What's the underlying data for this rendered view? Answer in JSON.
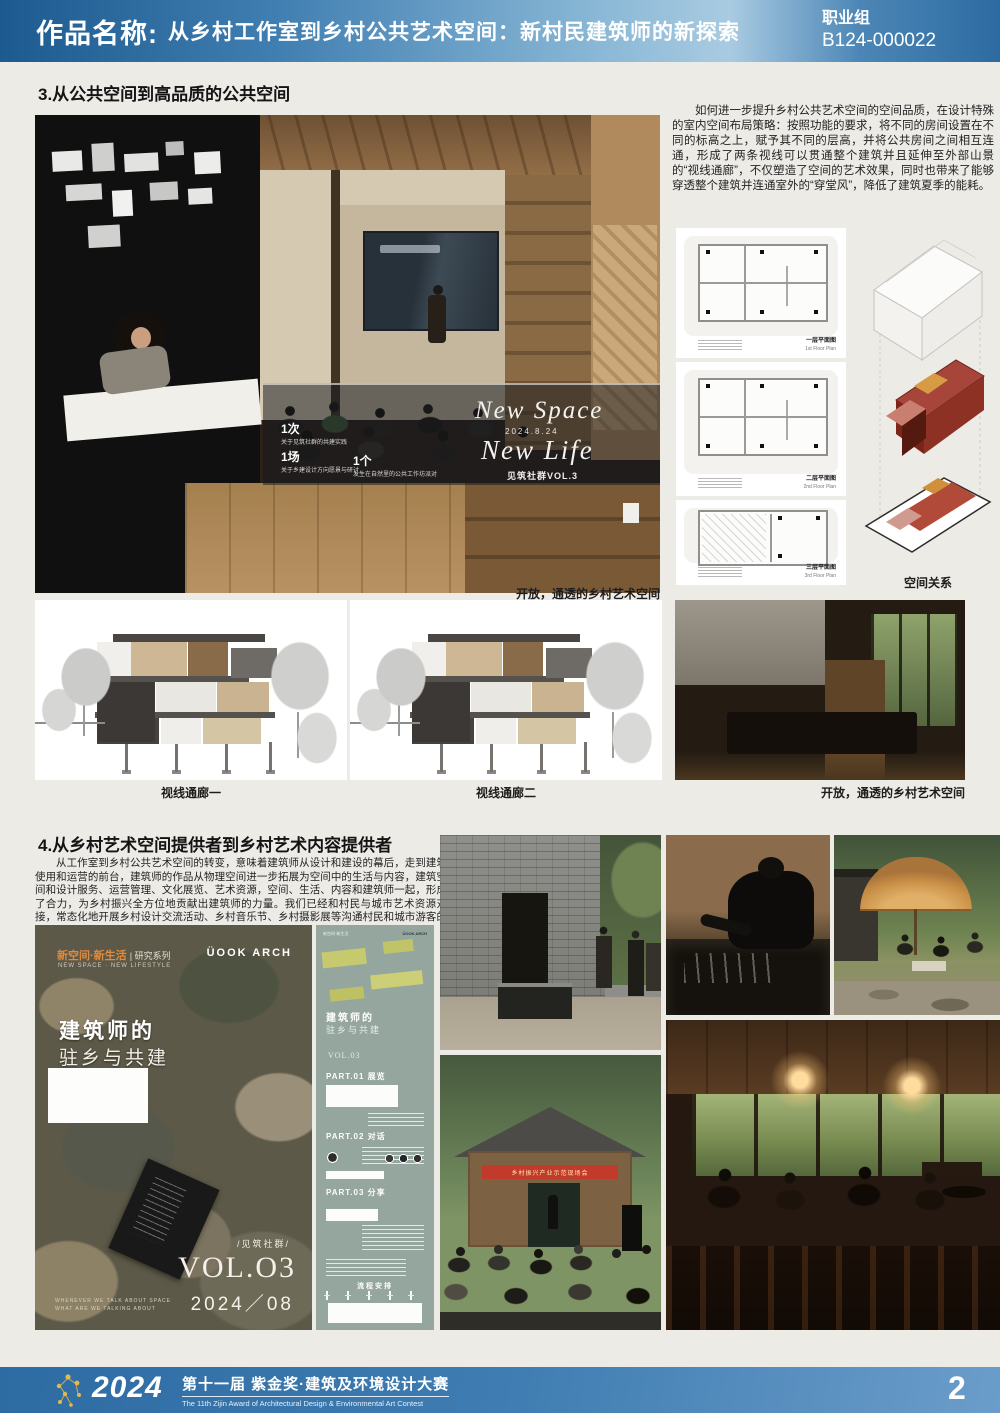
{
  "header": {
    "label": "作品名称:",
    "title": "从乡村工作室到乡村公共艺术空间：新村民建筑师的新探索",
    "group": "职业组",
    "entry_no": "B124-000022"
  },
  "section3": {
    "heading": "3.从公共空间到高品质的公共空间",
    "paragraph": "如何进一步提升乡村公共艺术空间的空间品质，在设计特殊的室内空间布局策略：按照功能的要求，将不同的房间设置在不同的标高之上，赋予其不同的层高，并将公共房间之间相互连通，形成了两条视线可以贯通整个建筑并且延伸至外部山景的“视线通廊”，不仅塑造了空间的艺术效果，同时也带来了能够穿透整个建筑并连通室外的“穿堂风”，降低了建筑夏季的能耗。",
    "photo_caption": "开放，通透的乡村艺术空间",
    "glass": {
      "title1": "New Space",
      "date": "2024.8.24",
      "title2": "New Life",
      "series": "见筑社群VOL.3",
      "stats": [
        {
          "num": "1次",
          "label": "关于见筑社群的共建实践"
        },
        {
          "num": "1场",
          "label": "关于乡建设计方向愿景与研讨"
        },
        {
          "num": "1个",
          "label": "发生在自然里的公共工作坊派对"
        }
      ]
    },
    "plans": [
      {
        "label": "一层平面图",
        "en": "1st Floor Plan"
      },
      {
        "label": "二层平面图",
        "en": "2nd Floor Plan"
      },
      {
        "label": "三层平面图",
        "en": "3rd Floor Plan"
      }
    ],
    "axon_caption": "空间关系",
    "section_captions": [
      "视线通廊一",
      "视线通廊二"
    ],
    "right_photo_caption": "开放，通透的乡村艺术空间"
  },
  "section4": {
    "heading": "4.从乡村艺术空间提供者到乡村艺术内容提供者",
    "paragraph": "从工作室到乡村公共艺术空间的转变，意味着建筑师从设计和建设的幕后，走到建筑使用和运营的前台，建筑师的作品从物理空间进一步拓展为空间中的生活与内容，建筑空间和设计服务、运营管理、文化展览、艺术资源，空间、生活、内容和建筑师一起，形成了合力，为乡村振兴全方位地贡献出建筑师的力量。我们已经和村民与城市艺术资源对接，常态化地开展乡村设计交流活动、乡村音乐节、乡村摄影展等沟通村民和城市游客的双向的艺术活动。",
    "booklet": {
      "tagline": "新空间·新生活",
      "tagline_suffix": "| 研究系列",
      "tagline_en": "NEW SPACE · NEW LIFESTYLE",
      "logo": "ÜOOK ARCH",
      "title1": "建筑师的",
      "title2": "驻乡与共建",
      "series": "/见筑社群/",
      "vol": "VOL.O3",
      "date": "2024／08",
      "footnote1": "WHENEVER WE TALK ABOUT SPACE",
      "footnote2": "WHAT ARE WE TALKING ABOUT"
    },
    "pamphlet": {
      "header_left": "新空间·新生活",
      "header_right": "ÜOOK ARCH",
      "title1": "建筑师的",
      "title2": "驻乡与共建",
      "vol": "VOL.03",
      "part1": "PART.01 展览",
      "part2": "PART.02 对话",
      "part3": "PART.03 分享",
      "schedule": "流程安排"
    },
    "event_banner": "乡村振兴产业示范现场会"
  },
  "footer": {
    "year": "2024",
    "title": "第十一届 紫金奖·建筑及环境设计大赛",
    "subtitle": "The 11th Zijin Award of Architectural Design & Environmental Art Contest",
    "page": "2"
  },
  "colors": {
    "header_blue_dark": "#1c5a8f",
    "header_blue_light": "#a9cbe1",
    "footer_blue": "#3e7cb1",
    "accent_gold": "#d8a93c",
    "accent_red": "#8e3125",
    "sage_green": "#95a69e",
    "page_bg": "#edebe6"
  }
}
